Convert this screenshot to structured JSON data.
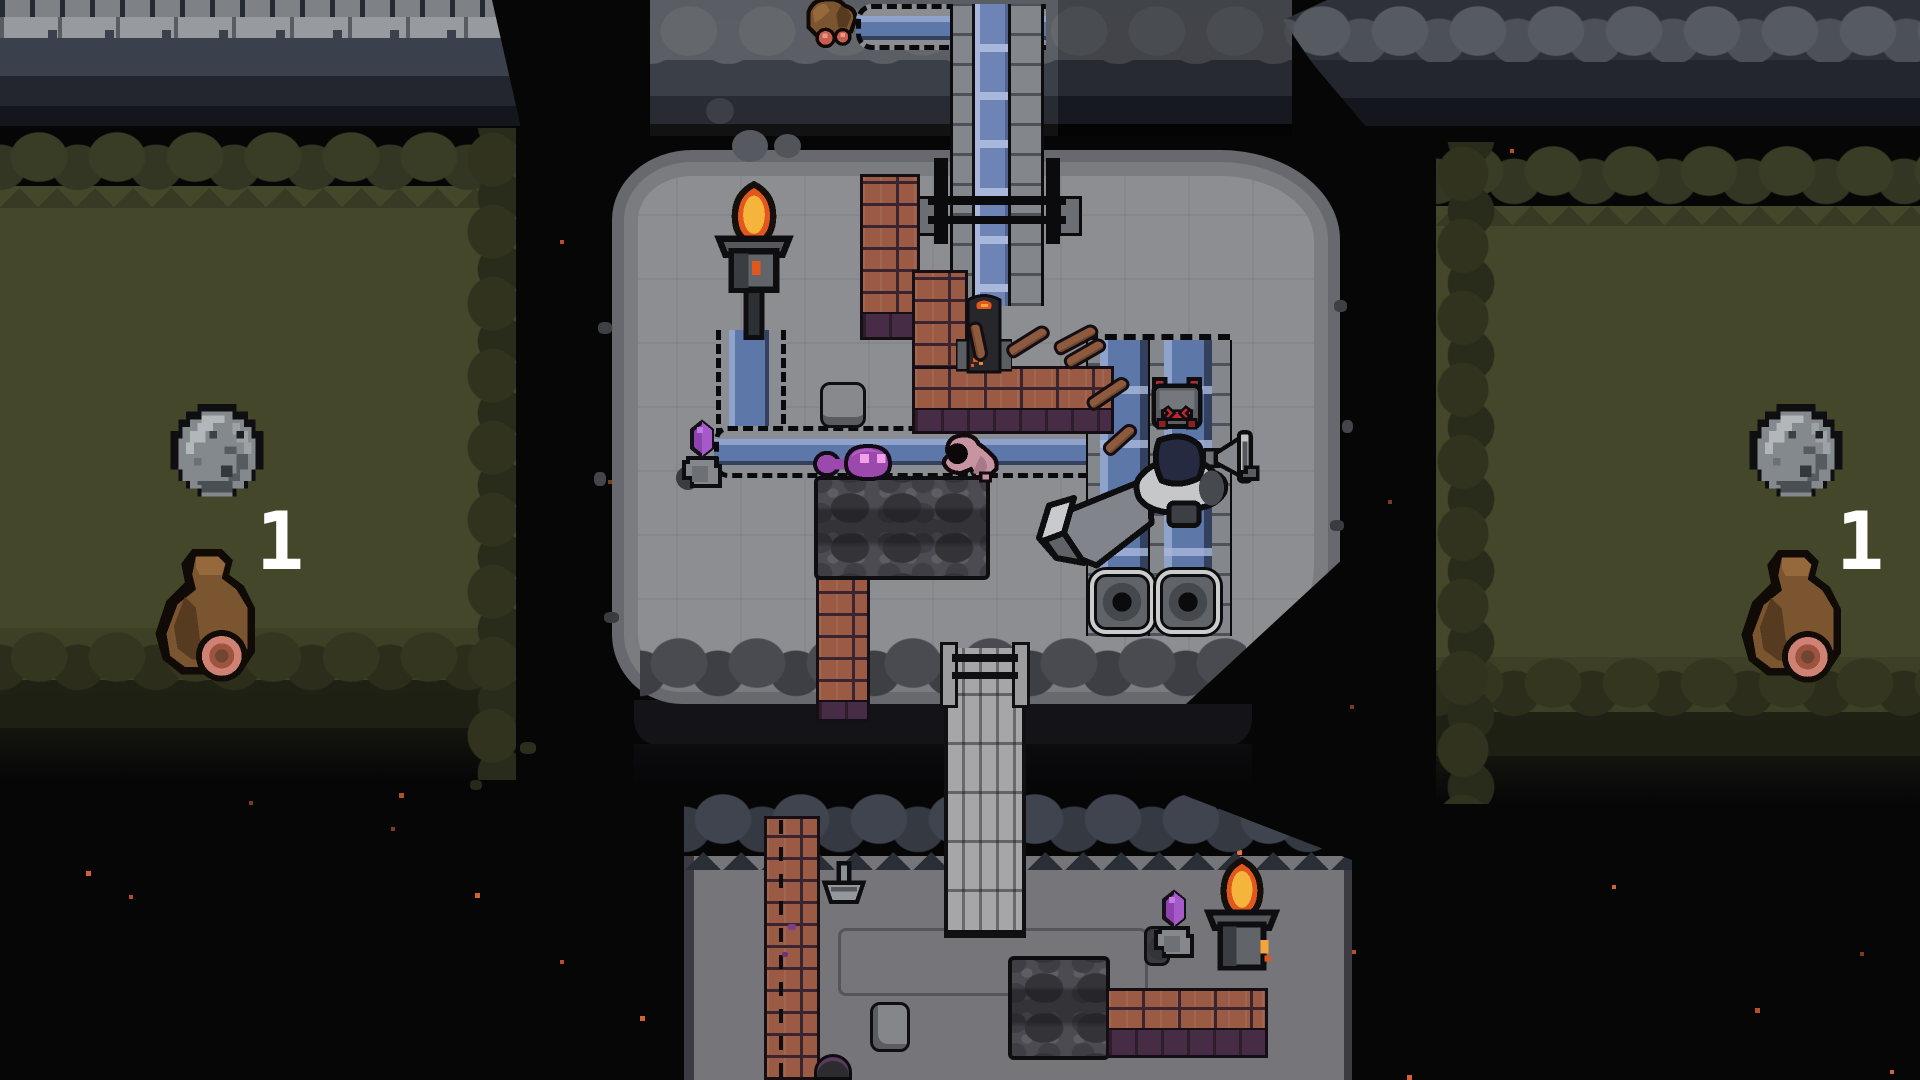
{
  "markers": {
    "left": {
      "label": "1"
    },
    "right": {
      "label": "1"
    }
  },
  "palette": {
    "bg": "#060607",
    "grass": "#45472a",
    "grass_stone": "#3a3d25",
    "grass_stone2": "#333623",
    "grass_dark": "#24261a",
    "island": "#8d8e92",
    "island_rim": "#696a6f",
    "cliff_light": "#979a9e",
    "cliff_mid": "#3a414c",
    "cliff_dark": "#23262e",
    "stoneband": "#575b61",
    "water": "#5d77a8",
    "water_light": "#8fa2cc",
    "water_dark": "#33415f",
    "water_cap": "#a9b7da",
    "channel_stone": "#8a8d91",
    "dash": "#0a0a0c",
    "brick": "#9a5a44",
    "brick_dark": "#3a2430",
    "brick_base": "#462c44",
    "flame": "#e2571d",
    "flame_core": "#f5b43c",
    "purple": "#8e42b0",
    "slime": "#9c49ae",
    "slime_eye": "#f2a0e8",
    "bag": "#7b5530",
    "bag_patch": "#cf8274",
    "wheel_rim": "#cbcccd",
    "metal": "#595c61",
    "metal_dark": "#34373c",
    "robot_red": "#c1272d",
    "bridge": "#a6a6a8",
    "moss": "#4b4b51",
    "moss_dark": "#333338",
    "bottom_floor": "#75757a",
    "bottom_stone": "#3f444e",
    "smoke": "#565a60",
    "white": "#ffffff"
  },
  "particle_colors": [
    "#b44f28",
    "#d06331",
    "#e2773f",
    "#7c3a1e"
  ],
  "particles": [
    [
      237,
      325,
      5,
      1
    ],
    [
      188,
      355,
      4,
      0
    ],
    [
      290,
      362,
      4,
      3
    ],
    [
      60,
      180,
      4,
      3
    ],
    [
      418,
      28,
      5,
      1
    ],
    [
      140,
      699,
      4,
      1
    ],
    [
      177,
      716,
      4,
      0
    ],
    [
      86,
      871,
      5,
      1
    ],
    [
      129,
      895,
      4,
      0
    ],
    [
      249,
      801,
      4,
      3
    ],
    [
      399,
      793,
      5,
      0
    ],
    [
      391,
      827,
      4,
      3
    ],
    [
      475,
      893,
      5,
      1
    ],
    [
      560,
      960,
      4,
      0
    ],
    [
      640,
      1016,
      5,
      1
    ],
    [
      700,
      870,
      4,
      3
    ],
    [
      905,
      1045,
      4,
      0
    ],
    [
      1076,
      1068,
      5,
      1
    ],
    [
      1237,
      850,
      5,
      2
    ],
    [
      1243,
      948,
      4,
      1
    ],
    [
      1190,
      1072,
      4,
      0
    ],
    [
      1407,
      1075,
      5,
      1
    ],
    [
      1350,
      705,
      4,
      3
    ],
    [
      1637,
      105,
      5,
      1
    ],
    [
      1510,
      149,
      4,
      0
    ],
    [
      1485,
      160,
      5,
      3
    ],
    [
      1453,
      204,
      4,
      0
    ],
    [
      1810,
      165,
      5,
      1
    ],
    [
      1642,
      209,
      4,
      3
    ],
    [
      1836,
      241,
      6,
      1
    ],
    [
      1798,
      265,
      6,
      0
    ],
    [
      1900,
      306,
      4,
      1
    ],
    [
      1557,
      364,
      4,
      3
    ],
    [
      1627,
      383,
      5,
      0
    ],
    [
      1696,
      348,
      4,
      1
    ],
    [
      1912,
      210,
      4,
      0
    ],
    [
      1612,
      885,
      4,
      1
    ],
    [
      1755,
      1008,
      5,
      0
    ],
    [
      1860,
      952,
      4,
      3
    ],
    [
      1890,
      1070,
      4,
      1
    ],
    [
      608,
      480,
      4,
      3
    ],
    [
      560,
      240,
      4,
      0
    ],
    [
      982,
      114,
      4,
      1
    ],
    [
      1345,
      80,
      4,
      3
    ],
    [
      720,
      95,
      4,
      0
    ],
    [
      1270,
      210,
      4,
      1
    ],
    [
      1388,
      500,
      4,
      3
    ],
    [
      1352,
      950,
      4,
      0
    ]
  ],
  "entities": {
    "left_zone": [
      "stone-orb",
      "loot-bag",
      "wave-number"
    ],
    "right_zone": [
      "stone-orb",
      "loot-bag",
      "wave-number"
    ],
    "top_zone": [
      "supply-bag",
      "aqueduct-channel",
      "gate"
    ],
    "island": [
      "torch",
      "smoke-puffs",
      "crystal-shrine",
      "purple-slime",
      "grub",
      "stone-pot",
      "moss-patch",
      "brick-walls",
      "water-channels",
      "furnace",
      "wood-clubs",
      "rat-robot",
      "horn-trap",
      "hooded-character-with-funnel",
      "drain-wheels"
    ],
    "bottom_zone": [
      "wood-bridge",
      "brick-walls",
      "goblet",
      "path-outline",
      "rock",
      "moss-patch",
      "crystal-shrine",
      "torch",
      "buried-pot"
    ]
  }
}
